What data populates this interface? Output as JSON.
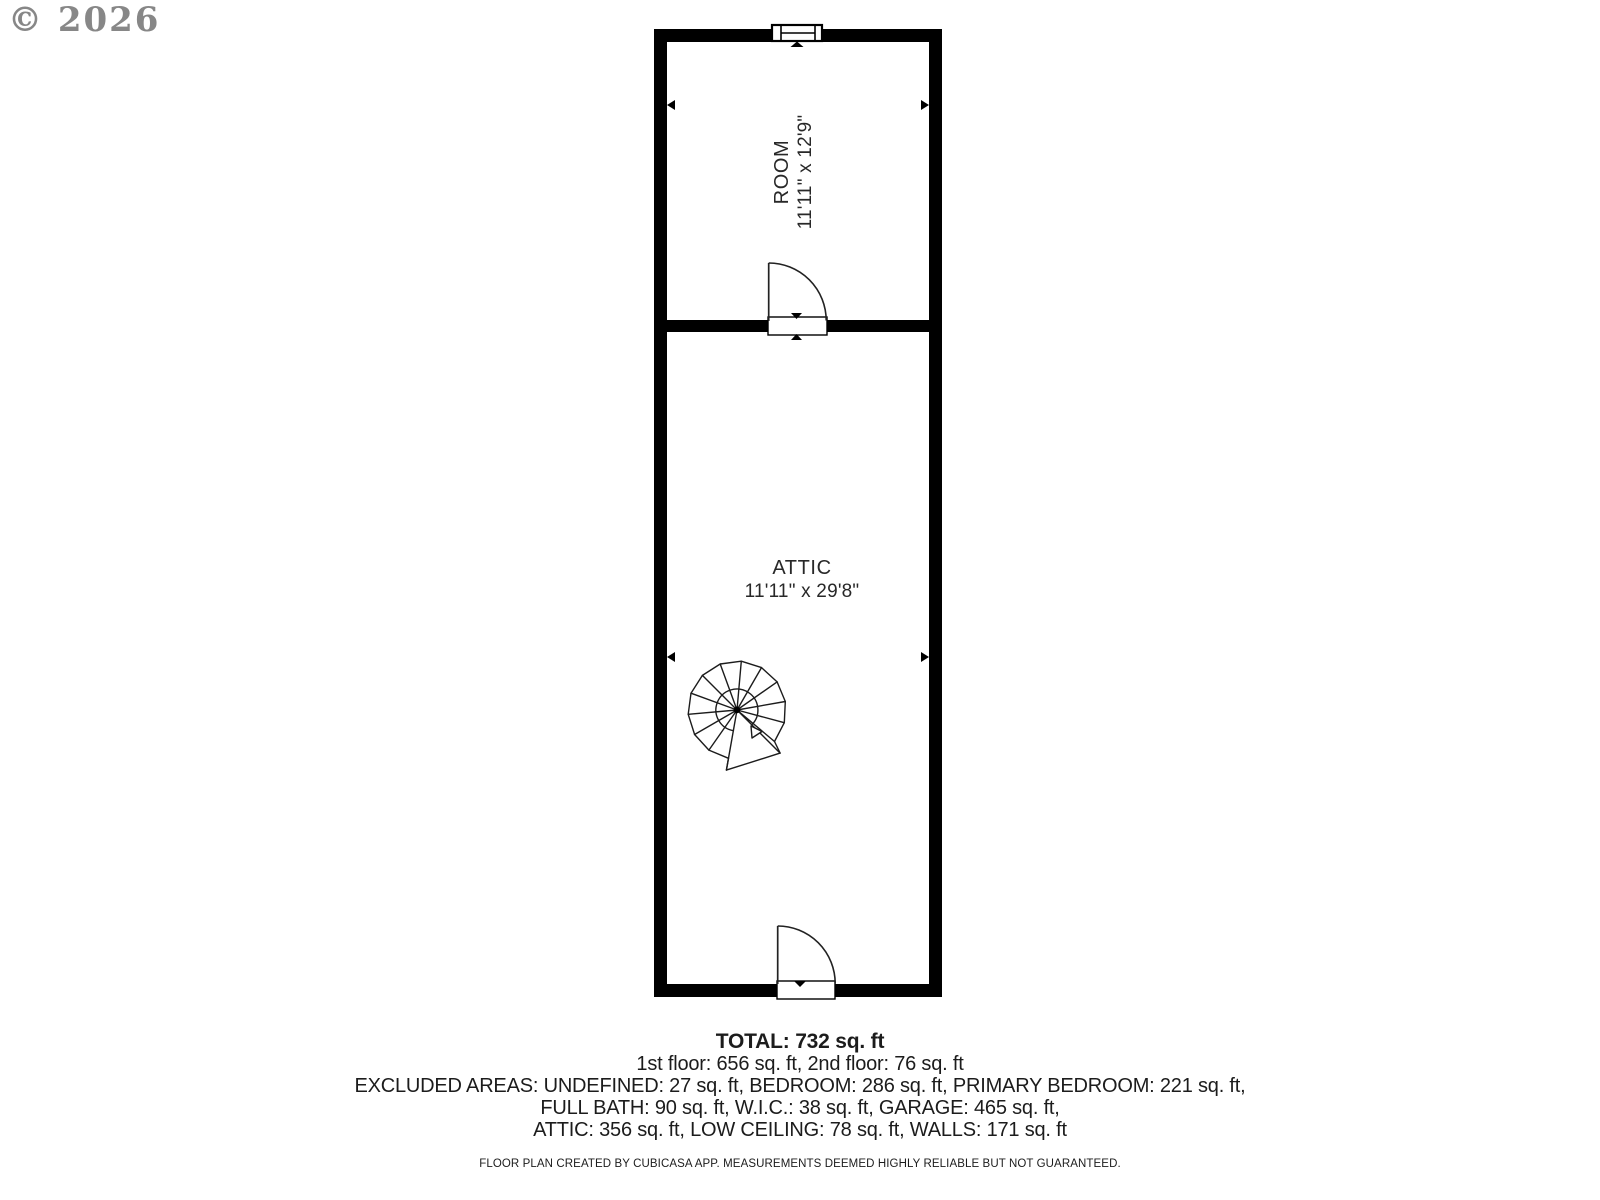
{
  "watermark": {
    "text": "© 2026"
  },
  "plan": {
    "rooms": [
      {
        "name": "ROOM",
        "dimensions": "11'11\" x 12'9\""
      },
      {
        "name": "ATTIC",
        "dimensions": "11'11\" x 29'8\""
      }
    ]
  },
  "summary": {
    "total": "TOTAL: 732 sq. ft",
    "floors": "1st floor: 656 sq. ft, 2nd floor: 76 sq. ft",
    "excluded_lines": [
      "EXCLUDED AREAS: UNDEFINED: 27 sq. ft, BEDROOM: 286 sq. ft, PRIMARY BEDROOM: 221 sq. ft,",
      "FULL BATH: 90 sq. ft, W.I.C.: 38 sq. ft, GARAGE: 465 sq. ft,",
      "ATTIC: 356 sq. ft, LOW CEILING: 78 sq. ft, WALLS: 171 sq. ft"
    ]
  },
  "footer": {
    "disclaimer": "FLOOR PLAN CREATED BY CUBICASA APP. MEASUREMENTS DEEMED HIGHLY RELIABLE BUT NOT GUARANTEED."
  },
  "colors": {
    "wall": "#000000",
    "text": "#1c1c1c",
    "watermark": "#878787",
    "background": "#ffffff"
  }
}
